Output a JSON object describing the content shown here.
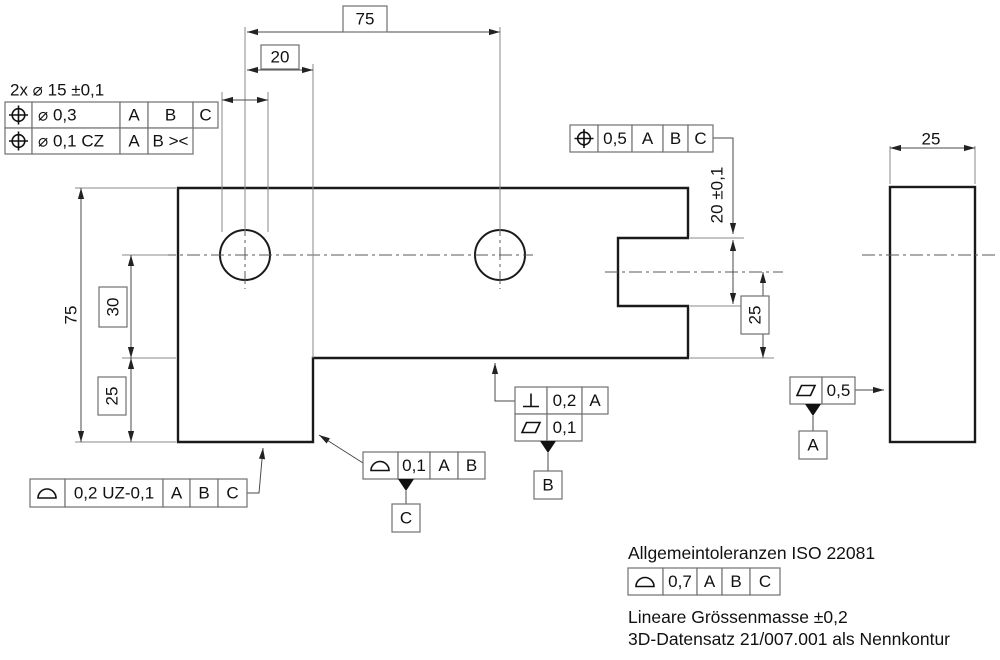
{
  "colors": {
    "background": "#ffffff",
    "outline": "#1a1a1a",
    "dimension_lines": "#4a4a4a",
    "frame_border": "#707070",
    "text": "#111111"
  },
  "dims": {
    "hole_callout": "2x ⌀ 15 ±0,1",
    "hole_pitch": "75",
    "hole_to_step": "20",
    "overall_height": "75",
    "center_to_step": "30",
    "step_to_bottom": "25",
    "notch_width": "20 ±0,1",
    "notch_center_to_bottom": "25",
    "side_thickness": "25"
  },
  "fcf_holes": {
    "row1": {
      "symbol": "position",
      "tol": "⌀ 0,3",
      "d1": "A",
      "d2": "B",
      "d3": "C"
    },
    "row2": {
      "symbol": "position",
      "tol": "⌀ 0,1 CZ",
      "d1": "A",
      "d2": "B ><"
    }
  },
  "fcf_notch": {
    "symbol": "position",
    "tol": "0,5",
    "d1": "A",
    "d2": "B",
    "d3": "C"
  },
  "fcf_bottom": {
    "perp_tol": "0,2",
    "perp_d1": "A",
    "flat_tol": "0,1",
    "datum": "B"
  },
  "fcf_step": {
    "symbol": "profile-of-surface",
    "tol": "0,1",
    "d1": "A",
    "d2": "B",
    "datum": "C"
  },
  "fcf_profile": {
    "symbol": "profile-of-surface",
    "tol": "0,2 UZ-0,1",
    "d1": "A",
    "d2": "B",
    "d3": "C"
  },
  "fcf_side": {
    "symbol": "flatness",
    "tol": "0,5",
    "datum": "A"
  },
  "fcf_general": {
    "symbol": "profile-of-surface",
    "tol": "0,7",
    "d1": "A",
    "d2": "B",
    "d3": "C"
  },
  "notes": {
    "line1": "Allgemeintoleranzen ISO 22081",
    "line2": "Lineare Grössenmasse ±0,2",
    "line3": "3D-Datensatz 21/007.001 als Nennkontur"
  }
}
